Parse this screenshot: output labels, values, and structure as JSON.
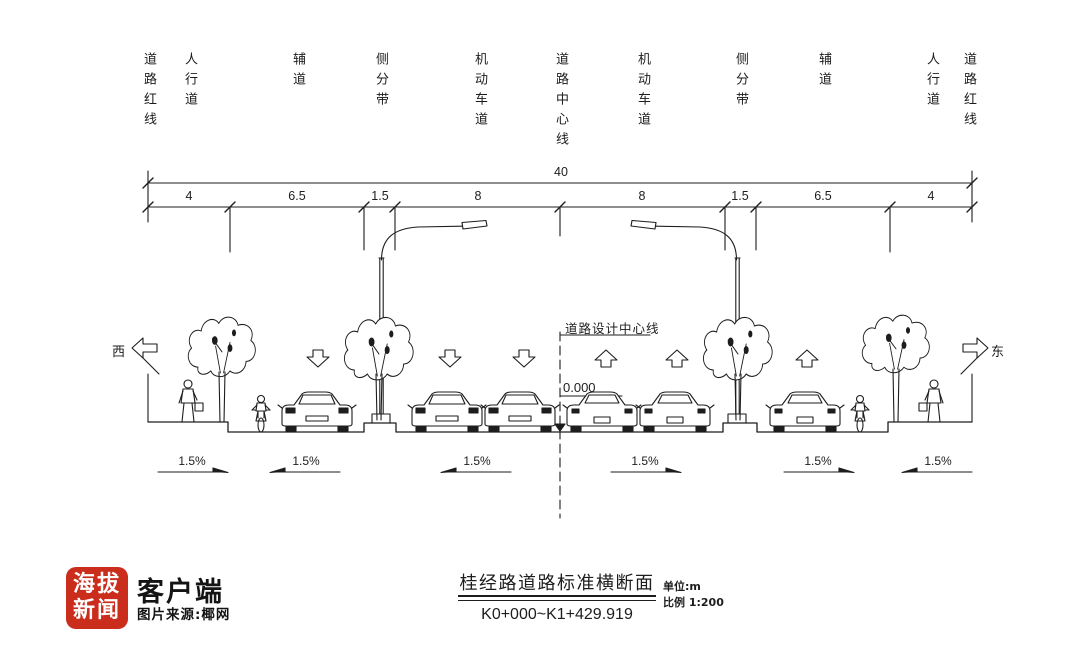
{
  "meta": {
    "background": "#ffffff",
    "ink": "#1d1d1d",
    "logo_red": "#cb2d1c"
  },
  "cross_section": {
    "zone_labels": [
      "道路红线",
      "人行道",
      "辅道",
      "侧分带",
      "机动车道",
      "道路中心线",
      "机动车道",
      "侧分带",
      "辅道",
      "人行道",
      "道路红线"
    ],
    "total_width": "40",
    "segments": [
      "4",
      "6.5",
      "1.5",
      "8",
      "8",
      "1.5",
      "6.5",
      "4"
    ],
    "direction_west": "西",
    "direction_east": "东",
    "design_centerline": "道路设计中心线",
    "elevation": "0.000",
    "slopes": [
      "1.5%",
      "1.5%",
      "1.5%",
      "1.5%",
      "1.5%",
      "1.5%"
    ]
  },
  "title_block": {
    "title": "桂经路道路标准横断面",
    "station_range": "K0+000~K1+429.919",
    "unit": "单位:m",
    "scale": "比例 1:200"
  },
  "watermark": {
    "brand_top": "海拔",
    "brand_bottom": "新闻",
    "app": "客户端",
    "source": "图片来源:椰网"
  }
}
